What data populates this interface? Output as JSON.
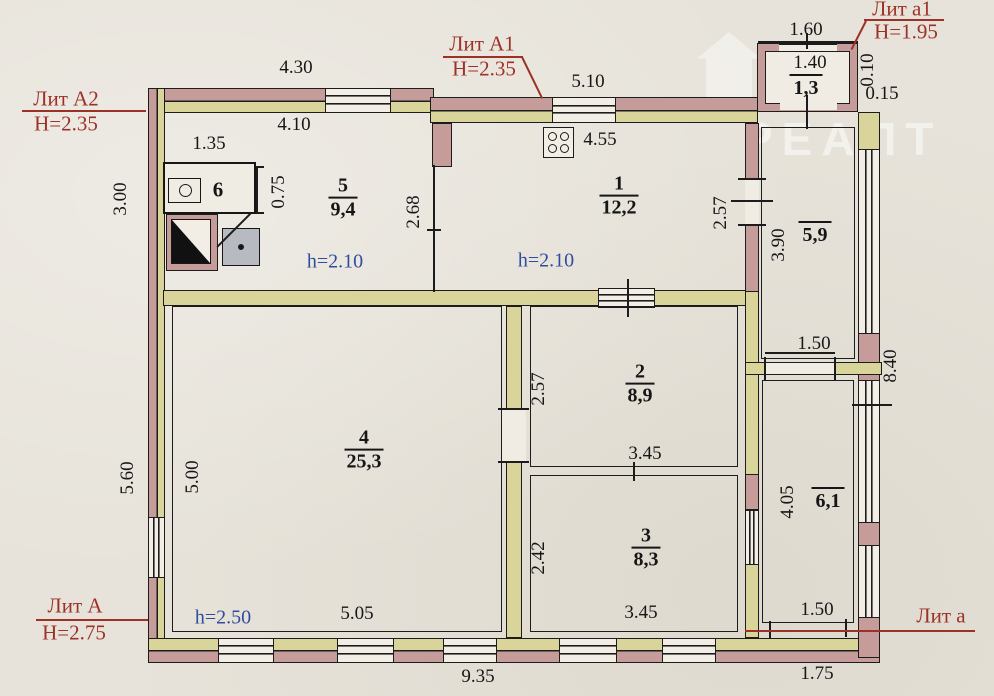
{
  "document": {
    "type": "BTI floor plan (поэтажный план)"
  },
  "litera": {
    "a2": {
      "label": "Лит А2",
      "height": "Н=2.35"
    },
    "a1": {
      "label": "Лит А1",
      "height": "Н=2.35"
    },
    "a1_small": {
      "label": "Лит а1",
      "height": "Н=1.95"
    },
    "a": {
      "label": "Лит А",
      "height": "Н=2.75"
    },
    "a_small": {
      "label": "Лит а"
    }
  },
  "rooms": {
    "r1": {
      "number": "1",
      "area": "12,2"
    },
    "r2": {
      "number": "2",
      "area": "8,9"
    },
    "r3": {
      "number": "3",
      "area": "8,3"
    },
    "r4": {
      "number": "4",
      "area": "25,3"
    },
    "r5": {
      "number": "5",
      "area": "9,4"
    },
    "r6": {
      "number": "6"
    },
    "veranda_corridor": {
      "area": "5,9"
    },
    "veranda_room": {
      "area": "6,1"
    },
    "porch": {
      "area": "1,3"
    }
  },
  "heights": {
    "h210_left": "h=2.10",
    "h210_right": "h=2.10",
    "h250": "h=2.50"
  },
  "dims": {
    "top_a2": "4.30",
    "top_a1": "5.10",
    "porch_top": "1.60",
    "inner_a2": "4.10",
    "closet_w": "1.35",
    "porch_inner": "1.40",
    "kitchen_w": "4.55",
    "closet_d": "0.75",
    "left_top": "3.00",
    "room5_h": "2.68",
    "room1_right": "2.57",
    "corridor_h": "3.90",
    "porch_side1": "0.10",
    "porch_side2": "0.15",
    "room2_left": "2.57",
    "room3_left": "2.42",
    "room2_w": "3.45",
    "room3_w": "3.45",
    "left_out": "5.60",
    "left_in": "5.00",
    "room4_w": "5.05",
    "bottom_main": "9.35",
    "bottom_veranda": "1.75",
    "corridor_door": "1.50",
    "veranda_door": "1.50",
    "right_side": "8.40",
    "veranda_room_h": "4.05"
  },
  "watermark": {
    "text": "РЕАЛТ"
  },
  "colors": {
    "wall_old": "#c69c9b",
    "wall_new": "#d8d49a",
    "label_red": "#9c3227",
    "label_blue": "#2f4d9e",
    "paper": "#e7e3da"
  }
}
